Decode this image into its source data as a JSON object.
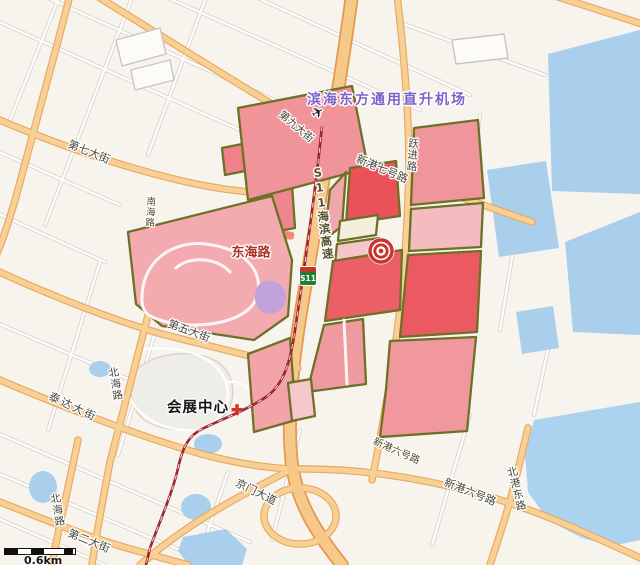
{
  "map": {
    "scale": {
      "label": "0.6km"
    },
    "pois": {
      "heliport": {
        "label": "滨海东方通用直升机场",
        "icon": "✈"
      },
      "convention_center": {
        "label": "会展中心"
      }
    },
    "roads": {
      "expressway": {
        "badge": "S11",
        "name": "S11海滨高速"
      },
      "street_9": "第九大街",
      "street_7": "第七大街",
      "street_5": "第五大街",
      "street_2": "第二大街",
      "xingang_7": "新港七号路",
      "xingang_6a": "新港六号路",
      "xingang_6b": "新港六号路",
      "yuejin": "跃进路",
      "donghai": "东海路",
      "nanhai": "南海路",
      "beihai_a": "北海路",
      "beihai_b": "北海路",
      "taida": "泰达大街",
      "jingmen": "京门大道",
      "beigang_east": "北港东路"
    },
    "colors": {
      "land": "#f7f4ee",
      "water": "#a9cfec",
      "road_major": "#f8d095",
      "road_major_casing": "#e8a95f",
      "parcel_border": "#6e7026",
      "parcel_red": "#ec5f66",
      "parcel_pink": "#f0989e",
      "parcel_light_pink": "#f5bfc3",
      "park_pink": "#f3abb0",
      "railway": "#9e2432",
      "poi_purple": "#7d62c8",
      "road_label_red": "#ab3326",
      "target_red": "#c9342e",
      "badge_green": "#1e7e34"
    }
  }
}
